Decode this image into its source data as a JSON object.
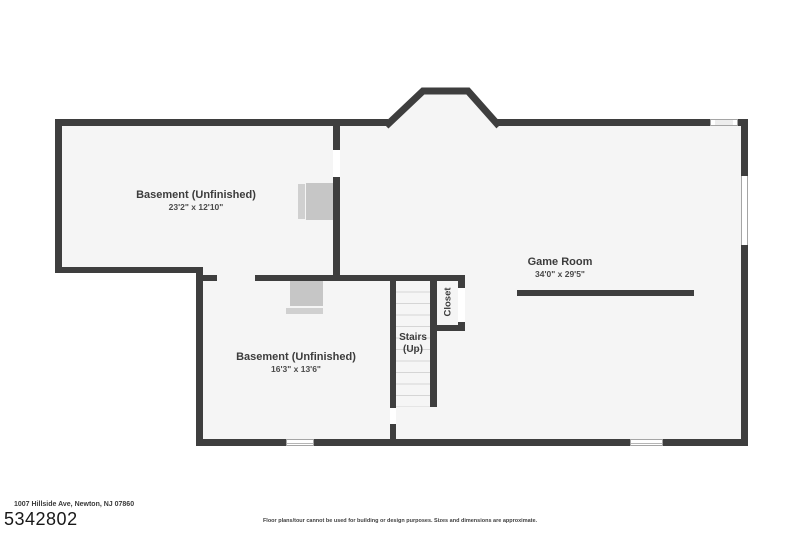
{
  "rooms": {
    "basement_upper": {
      "name": "Basement (Unfinished)",
      "dims": "23'2\" x 12'10\""
    },
    "game_room": {
      "name": "Game Room",
      "dims": "34'0\" x 29'5\""
    },
    "basement_lower": {
      "name": "Basement (Unfinished)",
      "dims": "16'3\" x 13'6\""
    },
    "stairs": {
      "name": "Stairs",
      "direction": "(Up)"
    },
    "closet": {
      "name": "Closet"
    }
  },
  "footer": {
    "address": "1007 Hillside Ave, Newton, NJ 07860",
    "listing_id": "5342802",
    "disclaimer": "Floor plans/tour cannot be used for building or design purposes. Sizes and dimensions are approximate."
  },
  "colors": {
    "wall": "#3e3e3e",
    "floor": "#f5f5f5",
    "background": "#ffffff",
    "appliance": "#c6c6c6",
    "window_border": "#a5a5a5"
  }
}
